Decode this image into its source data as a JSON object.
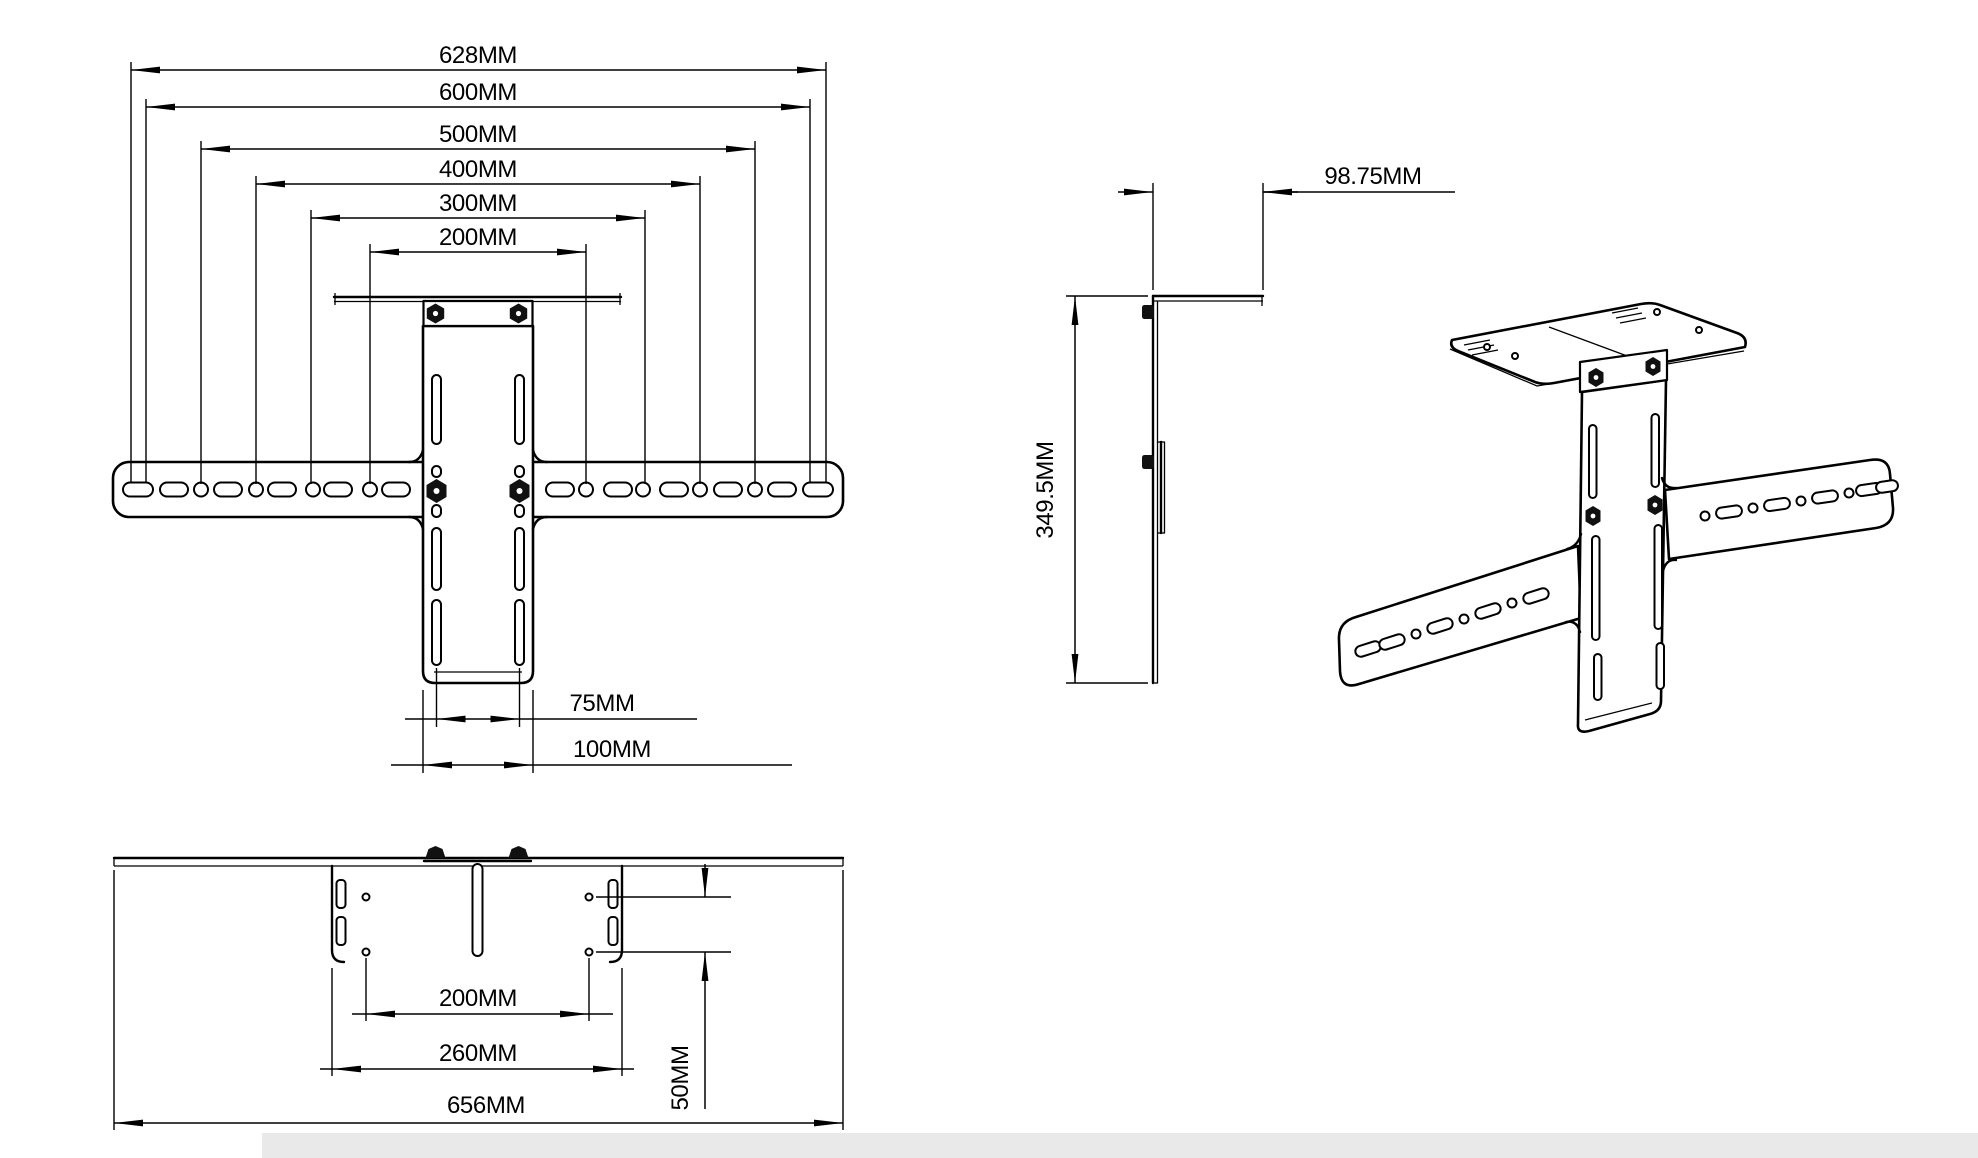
{
  "colors": {
    "line": "#000000",
    "background": "#ffffff",
    "shadow_band": "#e9e9e9"
  },
  "views": {
    "front": {
      "width_dims": [
        {
          "label": "628MM"
        },
        {
          "label": "600MM"
        },
        {
          "label": "500MM"
        },
        {
          "label": "400MM"
        },
        {
          "label": "300MM"
        },
        {
          "label": "200MM"
        }
      ],
      "lower_dims": [
        {
          "label": "75MM"
        },
        {
          "label": "100MM"
        }
      ]
    },
    "side": {
      "depth_dim": {
        "label": "98.75MM"
      },
      "height_dim": {
        "label": "349.5MM"
      }
    },
    "bottom": {
      "hole_span_dim": {
        "label": "200MM"
      },
      "plate_width_dim": {
        "label": "260MM"
      },
      "hole_offset_dim": {
        "label": "50MM"
      },
      "overall_width_dim": {
        "label": "656MM"
      }
    }
  }
}
